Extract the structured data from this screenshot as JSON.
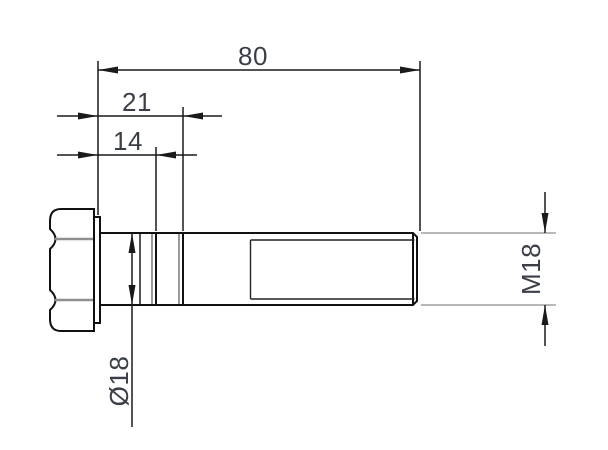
{
  "drawing": {
    "kind": "engineering-drawing",
    "subject": "hex-head-bolt-side-view",
    "dimensions": {
      "overall_length": {
        "label": "80"
      },
      "groove_far": {
        "label": "21"
      },
      "groove_near": {
        "label": "14"
      },
      "shank_diameter": {
        "label": "Ø18"
      },
      "thread_callout": {
        "label": "M18"
      }
    },
    "colors": {
      "outline": "#111111",
      "dim_text": "#3a3f47",
      "gray_edge": "#8f8f8f",
      "gray_extension": "#a0a0a0",
      "background": "#ffffff"
    }
  }
}
